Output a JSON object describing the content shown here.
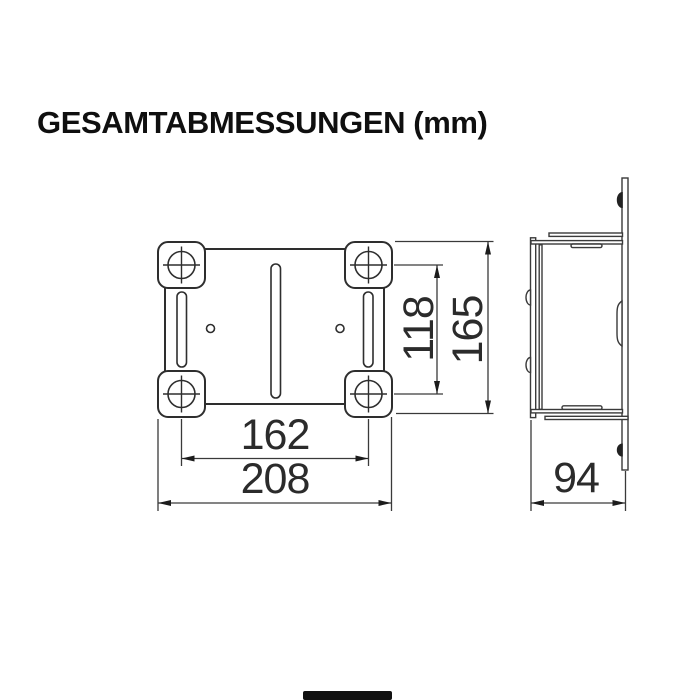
{
  "title": "GESAMTABMESSUNGEN (mm)",
  "views": {
    "front": {
      "dims": {
        "inner_width": "162",
        "outer_width": "208",
        "inner_height": "118",
        "outer_height": "165"
      }
    },
    "side": {
      "dims": {
        "depth": "94"
      }
    }
  },
  "colors": {
    "line": "#2e2e2e",
    "dim_line": "#3a3a3a",
    "text": "#2b2b2b"
  }
}
